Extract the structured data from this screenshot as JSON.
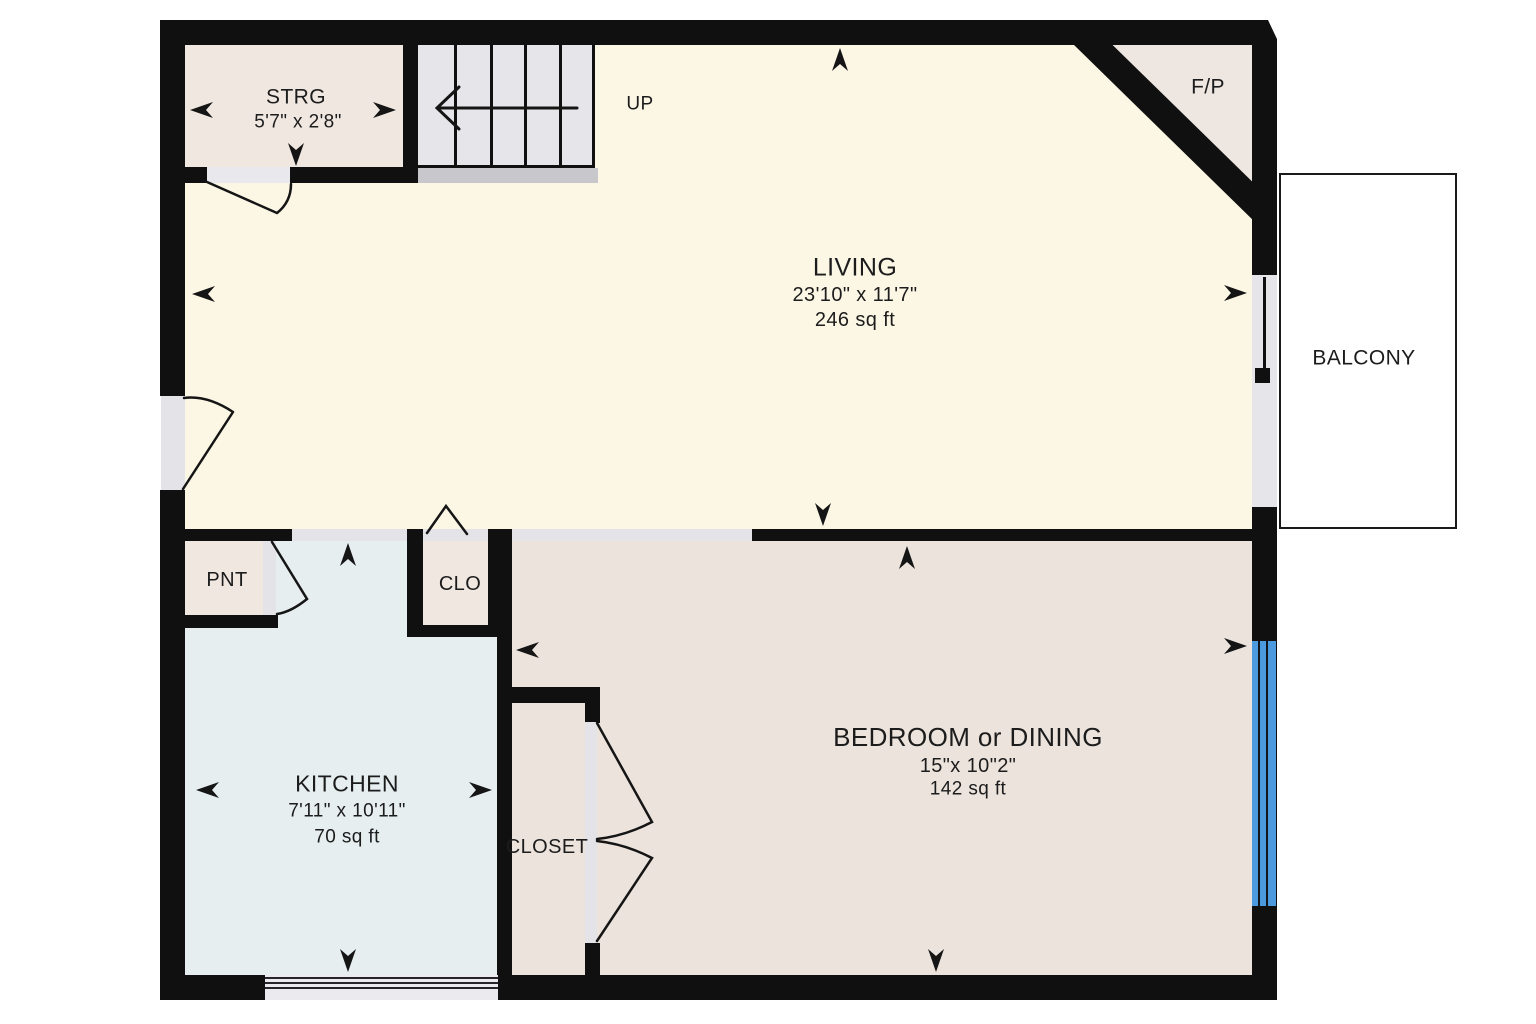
{
  "floorplan": {
    "colors": {
      "wall": "#101010",
      "living_fill": "#fcf7e5",
      "beige_fill": "#f0e7e1",
      "bedroom_fill": "#ece3dd",
      "kitchen_fill": "#e6eeef",
      "stairs_fill": "#e6e6ea",
      "landing_strip": "#c8c8cc",
      "opening_fill": "#e3e3e8",
      "window_blue": "#4b9adf",
      "balcony_fill": "#ffffff",
      "text": "#1c1c1c"
    },
    "rooms": {
      "living": {
        "name": "LIVING",
        "dimensions": "23'10\" x 11'7\"",
        "area": "246 sq ft"
      },
      "kitchen": {
        "name": "KITCHEN",
        "dimensions": "7'11\" x 10'11\"",
        "area": "70 sq ft"
      },
      "bedroom": {
        "name": "BEDROOM or DINING",
        "dimensions": "15\"x 10\"2\"",
        "area": "142 sq ft"
      },
      "storage": {
        "name": "STRG",
        "dimensions": "5'7\" x 2'8\""
      },
      "pantry": {
        "name": "PNT"
      },
      "clo": {
        "name": "CLO"
      },
      "closet": {
        "name": "CLOSET"
      },
      "fireplace": {
        "name": "F/P"
      },
      "balcony": {
        "name": "BALCONY"
      },
      "stairs": {
        "direction_label": "UP"
      }
    }
  }
}
